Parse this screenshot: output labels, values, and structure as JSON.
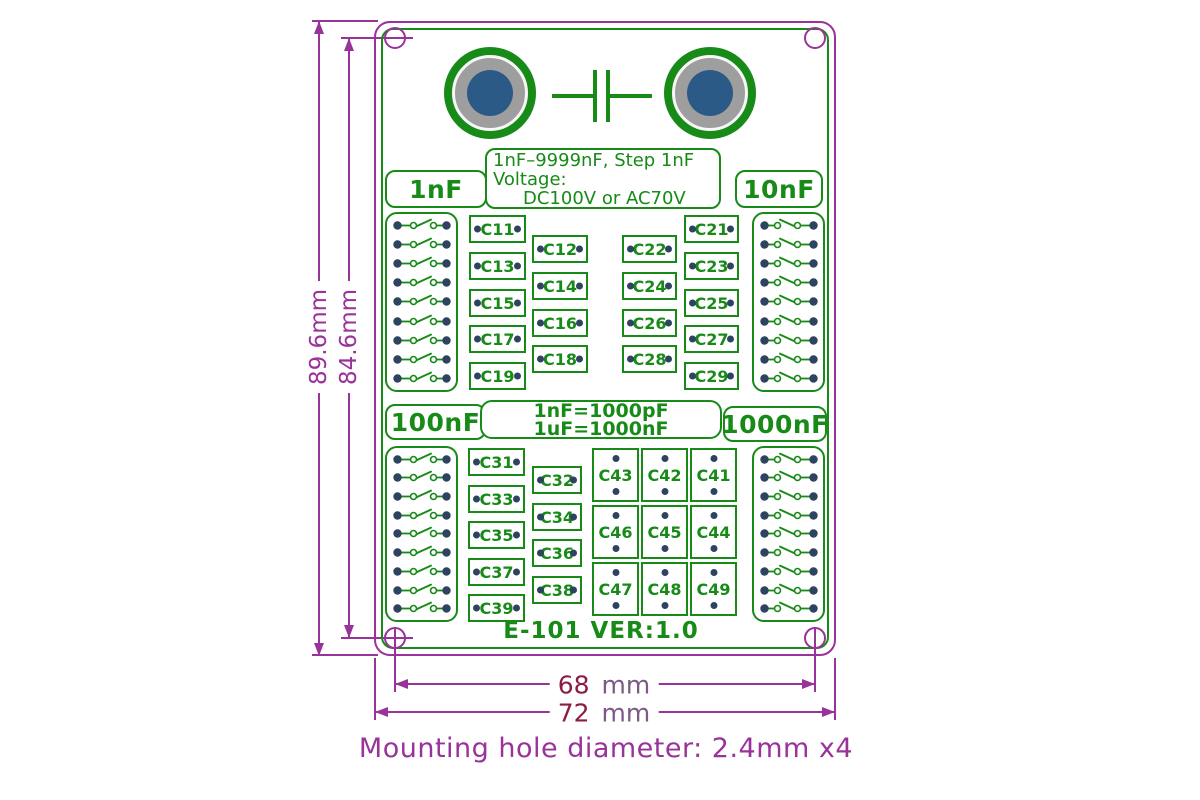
{
  "board": {
    "title_box": {
      "line1": "1nF–9999nF, Step 1nF",
      "line2": "Voltage:",
      "line3": "DC100V or AC70V"
    },
    "conversion_box": {
      "line1": "1nF=1000pF",
      "line2": "1uF=1000nF"
    },
    "version": "E-101 VER:1.0",
    "sections": [
      {
        "label": "1nF",
        "col_a": [
          "C11",
          "C13",
          "C15",
          "C17",
          "C19"
        ],
        "col_b": [
          "C12",
          "C14",
          "C16",
          "C18"
        ]
      },
      {
        "label": "10nF",
        "col_inner": [
          "C22",
          "C24",
          "C26",
          "C28"
        ],
        "col_outer": [
          "C21",
          "C23",
          "C25",
          "C27",
          "C29"
        ]
      },
      {
        "label": "100nF",
        "col_a": [
          "C31",
          "C33",
          "C35",
          "C37",
          "C39"
        ],
        "col_b": [
          "C32",
          "C34",
          "C36",
          "C38"
        ]
      },
      {
        "label": "1000nF",
        "grid": [
          [
            "C43",
            "C42",
            "C41"
          ],
          [
            "C46",
            "C45",
            "C44"
          ],
          [
            "C47",
            "C48",
            "C49"
          ]
        ]
      }
    ],
    "switch_banks": 4,
    "switches_per_bank": 9,
    "mounting_holes": 4
  },
  "dimensions": {
    "board_height": "89.6mm",
    "hole_spacing_vertical": "84.6mm",
    "hole_spacing_horizontal_value": "68",
    "hole_spacing_horizontal_unit": "mm",
    "board_width_value": "72",
    "board_width_unit": "mm",
    "mounting_note": "Mounting hole diameter: 2.4mm x4"
  },
  "colors": {
    "silkscreen_green": "#178a17",
    "dimension_purple": "#993399",
    "dimension_number": "#8b1c45",
    "pad_navy": "#2e4360",
    "terminal_blue": "#2a5a85",
    "terminal_gray": "#9e9e9e"
  }
}
